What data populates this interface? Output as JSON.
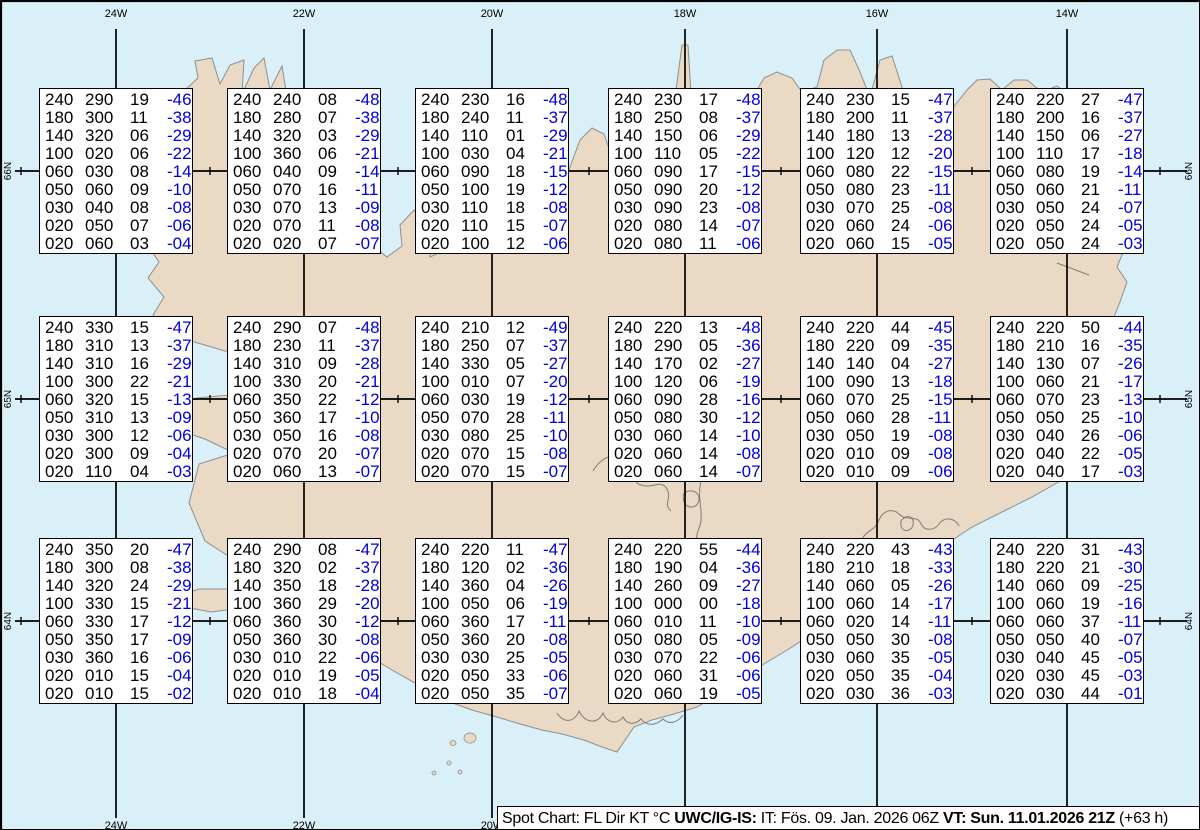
{
  "colors": {
    "sea": "#d9f0f8",
    "land": "#e9d9c5",
    "coast": "#8f8f8f",
    "graticule": "#000000",
    "value_text": "#000000",
    "temp_text": "#0000dd",
    "box_bg": "#ffffff",
    "footer_bg": "#ffffff"
  },
  "graticule": {
    "meridians": [
      {
        "label": "24W",
        "x": 115
      },
      {
        "label": "22W",
        "x": 303
      },
      {
        "label": "20W",
        "x": 491
      },
      {
        "label": "18W",
        "x": 684
      },
      {
        "label": "16W",
        "x": 876
      },
      {
        "label": "14W",
        "x": 1066
      }
    ],
    "parallels": [
      {
        "label": "66N",
        "y": 170
      },
      {
        "label": "65N",
        "y": 398
      },
      {
        "label": "64N",
        "y": 620
      }
    ]
  },
  "chart_data": {
    "type": "table",
    "title": "Spot Chart: FL Dir KT °C",
    "columns": [
      "FL",
      "Dir",
      "KT",
      "TempC"
    ],
    "stations": [
      {
        "lat": "66N",
        "lon": "24W",
        "rows": [
          [
            "240",
            "290",
            "19",
            "-46"
          ],
          [
            "180",
            "300",
            "11",
            "-38"
          ],
          [
            "140",
            "320",
            "06",
            "-29"
          ],
          [
            "100",
            "020",
            "06",
            "-22"
          ],
          [
            "060",
            "030",
            "08",
            "-14"
          ],
          [
            "050",
            "060",
            "09",
            "-10"
          ],
          [
            "030",
            "040",
            "08",
            "-08"
          ],
          [
            "020",
            "050",
            "07",
            "-06"
          ],
          [
            "020",
            "060",
            "03",
            "-04"
          ]
        ]
      },
      {
        "lat": "66N",
        "lon": "22W",
        "rows": [
          [
            "240",
            "240",
            "08",
            "-48"
          ],
          [
            "180",
            "280",
            "07",
            "-38"
          ],
          [
            "140",
            "320",
            "03",
            "-29"
          ],
          [
            "100",
            "360",
            "06",
            "-21"
          ],
          [
            "060",
            "040",
            "09",
            "-14"
          ],
          [
            "050",
            "070",
            "16",
            "-11"
          ],
          [
            "030",
            "070",
            "13",
            "-09"
          ],
          [
            "020",
            "070",
            "11",
            "-08"
          ],
          [
            "020",
            "020",
            "07",
            "-07"
          ]
        ]
      },
      {
        "lat": "66N",
        "lon": "20W",
        "rows": [
          [
            "240",
            "230",
            "16",
            "-48"
          ],
          [
            "180",
            "240",
            "11",
            "-37"
          ],
          [
            "140",
            "110",
            "01",
            "-29"
          ],
          [
            "100",
            "030",
            "04",
            "-21"
          ],
          [
            "060",
            "090",
            "18",
            "-15"
          ],
          [
            "050",
            "100",
            "19",
            "-12"
          ],
          [
            "030",
            "110",
            "18",
            "-08"
          ],
          [
            "020",
            "110",
            "15",
            "-07"
          ],
          [
            "020",
            "100",
            "12",
            "-06"
          ]
        ]
      },
      {
        "lat": "66N",
        "lon": "18W",
        "rows": [
          [
            "240",
            "230",
            "17",
            "-48"
          ],
          [
            "180",
            "250",
            "08",
            "-37"
          ],
          [
            "140",
            "150",
            "06",
            "-29"
          ],
          [
            "100",
            "110",
            "05",
            "-22"
          ],
          [
            "060",
            "090",
            "17",
            "-15"
          ],
          [
            "050",
            "090",
            "20",
            "-12"
          ],
          [
            "030",
            "090",
            "23",
            "-08"
          ],
          [
            "020",
            "080",
            "14",
            "-07"
          ],
          [
            "020",
            "080",
            "11",
            "-06"
          ]
        ]
      },
      {
        "lat": "66N",
        "lon": "16W",
        "rows": [
          [
            "240",
            "230",
            "15",
            "-47"
          ],
          [
            "180",
            "200",
            "11",
            "-37"
          ],
          [
            "140",
            "180",
            "13",
            "-28"
          ],
          [
            "100",
            "120",
            "12",
            "-20"
          ],
          [
            "060",
            "080",
            "22",
            "-15"
          ],
          [
            "050",
            "080",
            "23",
            "-11"
          ],
          [
            "030",
            "070",
            "25",
            "-08"
          ],
          [
            "020",
            "060",
            "24",
            "-06"
          ],
          [
            "020",
            "060",
            "15",
            "-05"
          ]
        ]
      },
      {
        "lat": "66N",
        "lon": "14W",
        "rows": [
          [
            "240",
            "220",
            "27",
            "-47"
          ],
          [
            "180",
            "200",
            "16",
            "-37"
          ],
          [
            "140",
            "150",
            "06",
            "-27"
          ],
          [
            "100",
            "110",
            "17",
            "-18"
          ],
          [
            "060",
            "080",
            "19",
            "-14"
          ],
          [
            "050",
            "060",
            "21",
            "-11"
          ],
          [
            "030",
            "050",
            "24",
            "-07"
          ],
          [
            "020",
            "050",
            "24",
            "-05"
          ],
          [
            "020",
            "050",
            "24",
            "-03"
          ]
        ]
      },
      {
        "lat": "65N",
        "lon": "24W",
        "rows": [
          [
            "240",
            "330",
            "15",
            "-47"
          ],
          [
            "180",
            "310",
            "13",
            "-37"
          ],
          [
            "140",
            "310",
            "16",
            "-29"
          ],
          [
            "100",
            "300",
            "22",
            "-21"
          ],
          [
            "060",
            "320",
            "15",
            "-13"
          ],
          [
            "050",
            "310",
            "13",
            "-09"
          ],
          [
            "030",
            "300",
            "12",
            "-06"
          ],
          [
            "020",
            "300",
            "09",
            "-04"
          ],
          [
            "020",
            "110",
            "04",
            "-03"
          ]
        ]
      },
      {
        "lat": "65N",
        "lon": "22W",
        "rows": [
          [
            "240",
            "290",
            "07",
            "-48"
          ],
          [
            "180",
            "230",
            "11",
            "-37"
          ],
          [
            "140",
            "310",
            "09",
            "-28"
          ],
          [
            "100",
            "330",
            "20",
            "-21"
          ],
          [
            "060",
            "350",
            "22",
            "-12"
          ],
          [
            "050",
            "360",
            "17",
            "-10"
          ],
          [
            "030",
            "050",
            "16",
            "-08"
          ],
          [
            "020",
            "070",
            "20",
            "-07"
          ],
          [
            "020",
            "060",
            "13",
            "-07"
          ]
        ]
      },
      {
        "lat": "65N",
        "lon": "20W",
        "rows": [
          [
            "240",
            "210",
            "12",
            "-49"
          ],
          [
            "180",
            "250",
            "07",
            "-37"
          ],
          [
            "140",
            "330",
            "05",
            "-27"
          ],
          [
            "100",
            "010",
            "07",
            "-20"
          ],
          [
            "060",
            "030",
            "19",
            "-12"
          ],
          [
            "050",
            "070",
            "28",
            "-11"
          ],
          [
            "030",
            "080",
            "25",
            "-10"
          ],
          [
            "020",
            "070",
            "15",
            "-08"
          ],
          [
            "020",
            "070",
            "15",
            "-07"
          ]
        ]
      },
      {
        "lat": "65N",
        "lon": "18W",
        "rows": [
          [
            "240",
            "220",
            "13",
            "-48"
          ],
          [
            "180",
            "290",
            "05",
            "-36"
          ],
          [
            "140",
            "170",
            "02",
            "-27"
          ],
          [
            "100",
            "120",
            "06",
            "-19"
          ],
          [
            "060",
            "090",
            "28",
            "-16"
          ],
          [
            "050",
            "080",
            "30",
            "-12"
          ],
          [
            "030",
            "060",
            "14",
            "-10"
          ],
          [
            "020",
            "060",
            "14",
            "-08"
          ],
          [
            "020",
            "060",
            "14",
            "-07"
          ]
        ]
      },
      {
        "lat": "65N",
        "lon": "16W",
        "rows": [
          [
            "240",
            "220",
            "44",
            "-45"
          ],
          [
            "180",
            "220",
            "09",
            "-35"
          ],
          [
            "140",
            "140",
            "04",
            "-27"
          ],
          [
            "100",
            "090",
            "13",
            "-18"
          ],
          [
            "060",
            "070",
            "25",
            "-15"
          ],
          [
            "050",
            "060",
            "28",
            "-11"
          ],
          [
            "030",
            "050",
            "19",
            "-08"
          ],
          [
            "020",
            "010",
            "09",
            "-08"
          ],
          [
            "020",
            "010",
            "09",
            "-06"
          ]
        ]
      },
      {
        "lat": "65N",
        "lon": "14W",
        "rows": [
          [
            "240",
            "220",
            "50",
            "-44"
          ],
          [
            "180",
            "210",
            "16",
            "-35"
          ],
          [
            "140",
            "130",
            "07",
            "-26"
          ],
          [
            "100",
            "060",
            "21",
            "-17"
          ],
          [
            "060",
            "070",
            "23",
            "-13"
          ],
          [
            "050",
            "050",
            "25",
            "-10"
          ],
          [
            "030",
            "040",
            "26",
            "-06"
          ],
          [
            "020",
            "040",
            "22",
            "-05"
          ],
          [
            "020",
            "040",
            "17",
            "-03"
          ]
        ]
      },
      {
        "lat": "64N",
        "lon": "24W",
        "rows": [
          [
            "240",
            "350",
            "20",
            "-47"
          ],
          [
            "180",
            "300",
            "08",
            "-38"
          ],
          [
            "140",
            "320",
            "24",
            "-29"
          ],
          [
            "100",
            "330",
            "15",
            "-21"
          ],
          [
            "060",
            "330",
            "17",
            "-12"
          ],
          [
            "050",
            "350",
            "17",
            "-09"
          ],
          [
            "030",
            "360",
            "16",
            "-06"
          ],
          [
            "020",
            "010",
            "15",
            "-04"
          ],
          [
            "020",
            "010",
            "15",
            "-02"
          ]
        ]
      },
      {
        "lat": "64N",
        "lon": "22W",
        "rows": [
          [
            "240",
            "290",
            "08",
            "-47"
          ],
          [
            "180",
            "320",
            "02",
            "-37"
          ],
          [
            "140",
            "350",
            "18",
            "-28"
          ],
          [
            "100",
            "360",
            "29",
            "-20"
          ],
          [
            "060",
            "360",
            "30",
            "-12"
          ],
          [
            "050",
            "360",
            "30",
            "-08"
          ],
          [
            "030",
            "010",
            "22",
            "-06"
          ],
          [
            "020",
            "010",
            "19",
            "-05"
          ],
          [
            "020",
            "010",
            "18",
            "-04"
          ]
        ]
      },
      {
        "lat": "64N",
        "lon": "20W",
        "rows": [
          [
            "240",
            "220",
            "11",
            "-47"
          ],
          [
            "180",
            "120",
            "02",
            "-36"
          ],
          [
            "140",
            "360",
            "04",
            "-26"
          ],
          [
            "100",
            "050",
            "06",
            "-19"
          ],
          [
            "060",
            "360",
            "17",
            "-11"
          ],
          [
            "050",
            "360",
            "20",
            "-08"
          ],
          [
            "030",
            "030",
            "25",
            "-05"
          ],
          [
            "020",
            "050",
            "33",
            "-06"
          ],
          [
            "020",
            "050",
            "35",
            "-07"
          ]
        ]
      },
      {
        "lat": "64N",
        "lon": "18W",
        "rows": [
          [
            "240",
            "220",
            "55",
            "-44"
          ],
          [
            "180",
            "190",
            "04",
            "-36"
          ],
          [
            "140",
            "260",
            "09",
            "-27"
          ],
          [
            "100",
            "000",
            "00",
            "-18"
          ],
          [
            "060",
            "010",
            "11",
            "-10"
          ],
          [
            "050",
            "080",
            "05",
            "-09"
          ],
          [
            "030",
            "070",
            "22",
            "-06"
          ],
          [
            "020",
            "060",
            "31",
            "-06"
          ],
          [
            "020",
            "060",
            "19",
            "-05"
          ]
        ]
      },
      {
        "lat": "64N",
        "lon": "16W",
        "rows": [
          [
            "240",
            "220",
            "43",
            "-43"
          ],
          [
            "180",
            "210",
            "18",
            "-33"
          ],
          [
            "140",
            "060",
            "05",
            "-26"
          ],
          [
            "100",
            "060",
            "14",
            "-17"
          ],
          [
            "060",
            "020",
            "14",
            "-11"
          ],
          [
            "050",
            "050",
            "30",
            "-08"
          ],
          [
            "030",
            "060",
            "35",
            "-05"
          ],
          [
            "020",
            "050",
            "35",
            "-04"
          ],
          [
            "020",
            "030",
            "36",
            "-03"
          ]
        ]
      },
      {
        "lat": "64N",
        "lon": "14W",
        "rows": [
          [
            "240",
            "220",
            "31",
            "-43"
          ],
          [
            "180",
            "220",
            "21",
            "-30"
          ],
          [
            "140",
            "060",
            "09",
            "-25"
          ],
          [
            "100",
            "060",
            "19",
            "-16"
          ],
          [
            "060",
            "060",
            "37",
            "-11"
          ],
          [
            "050",
            "050",
            "40",
            "-07"
          ],
          [
            "030",
            "040",
            "45",
            "-05"
          ],
          [
            "020",
            "030",
            "45",
            "-03"
          ],
          [
            "020",
            "030",
            "44",
            "-01"
          ]
        ]
      }
    ]
  },
  "footer": {
    "segments": [
      {
        "text": "Spot Chart: FL Dir KT °C ",
        "bold": false
      },
      {
        "text": "UWC/IG-IS:",
        "bold": true
      },
      {
        "text": " IT: Fös. 09. Jan. 2026 06Z ",
        "bold": false
      },
      {
        "text": "VT: Sun. 11.01.2026 21Z",
        "bold": true
      },
      {
        "text": " (+63 h)",
        "bold": false
      }
    ]
  }
}
